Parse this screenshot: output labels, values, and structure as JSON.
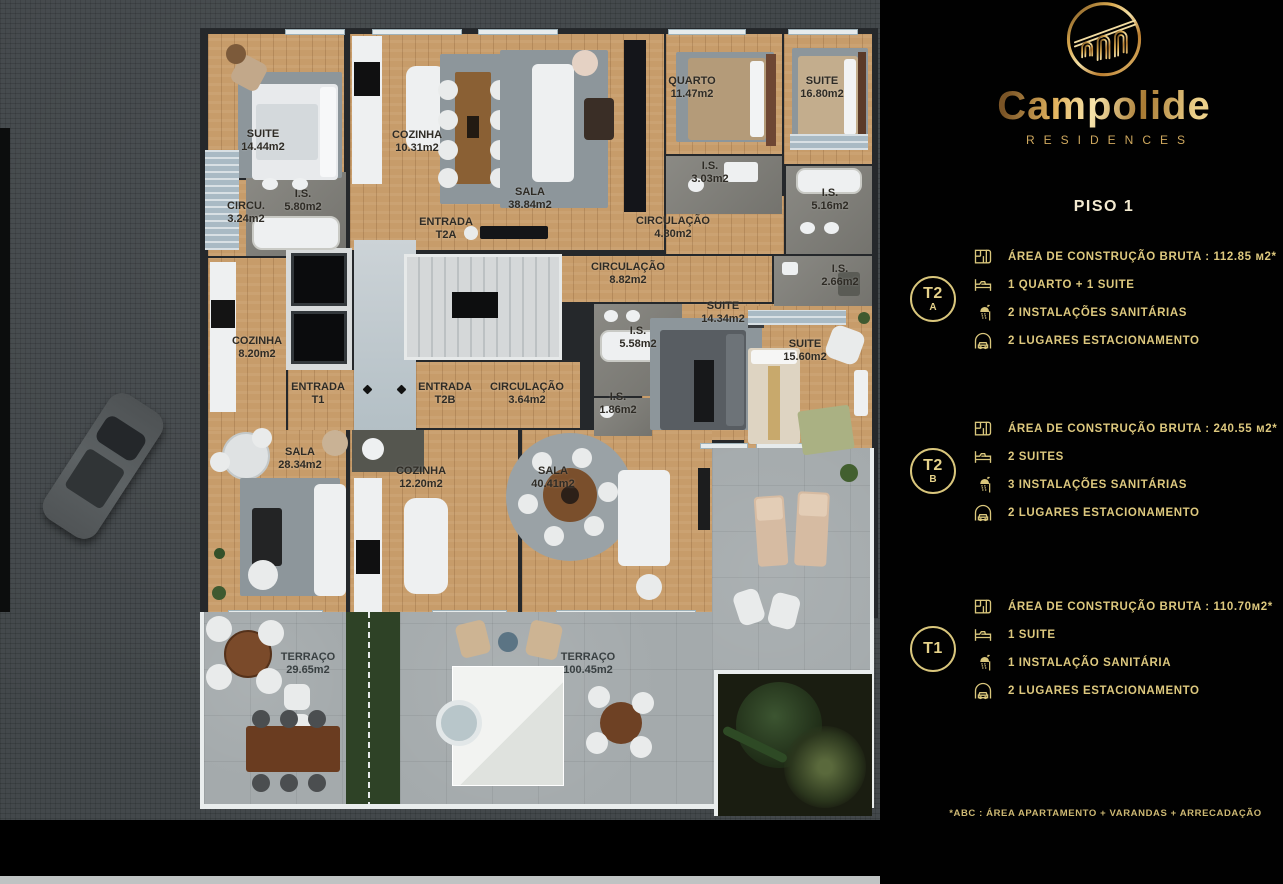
{
  "panel": {
    "brand": "Campolide",
    "brand_sub": "RESIDENCES",
    "floor_title": "PISO 1",
    "accent_color": "#d9c67c",
    "background_color": "#000000",
    "units": [
      {
        "badge": "T2",
        "badge_sub": "A",
        "rows": [
          {
            "icon": "floorplan-icon",
            "text": "ÁREA DE CONSTRUÇÃO BRUTA :  112.85 м2*"
          },
          {
            "icon": "bed-icon",
            "text": "1 QUARTO + 1 SUITE"
          },
          {
            "icon": "shower-icon",
            "text": "2 INSTALAÇÕES SANITÁRIAS"
          },
          {
            "icon": "garage-icon",
            "text": "2 LUGARES ESTACIONAMENTO"
          }
        ]
      },
      {
        "badge": "T2",
        "badge_sub": "B",
        "rows": [
          {
            "icon": "floorplan-icon",
            "text": "ÁREA DE CONSTRUÇÃO BRUTA :  240.55 м2*"
          },
          {
            "icon": "bed-icon",
            "text": "2 SUITES"
          },
          {
            "icon": "shower-icon",
            "text": "3 INSTALAÇÕES SANITÁRIAS"
          },
          {
            "icon": "garage-icon",
            "text": "2 LUGARES ESTACIONAMENTO"
          }
        ]
      },
      {
        "badge": "T1",
        "badge_sub": "",
        "rows": [
          {
            "icon": "floorplan-icon",
            "text": "ÁREA DE CONSTRUÇÃO BRUTA :  110.70м2*"
          },
          {
            "icon": "bed-icon",
            "text": "1 SUITE"
          },
          {
            "icon": "shower-icon",
            "text": "1 INSTALAÇÃO SANITÁRIA"
          },
          {
            "icon": "garage-icon",
            "text": "2 LUGARES ESTACIONAMENTO"
          }
        ]
      }
    ],
    "footnote": "*ABC :  ÁREA APARTAMENTO + VARANDAS + ARRECADAÇÃO"
  },
  "plan": {
    "floor_color": "#c79c6a",
    "terrace_color": "#a4aaac",
    "ground_color": "#43484b",
    "labels": {
      "suite_t1": {
        "name": "SUITE",
        "area": "14.44m2"
      },
      "circ_t1": {
        "name": "CIRCU.",
        "area": "3.24m2"
      },
      "is580": {
        "name": "I.S.",
        "area": "5.80m2"
      },
      "cozinha_t2a": {
        "name": "COZINHA",
        "area": "10.31m2"
      },
      "sala_t2a": {
        "name": "SALA",
        "area": "38.84m2"
      },
      "entrada_t2a": {
        "name": "ENTRADA",
        "area": "T2A"
      },
      "quarto_t2b": {
        "name": "QUARTO",
        "area": "11.47m2"
      },
      "is303": {
        "name": "I.S.",
        "area": "3.03m2"
      },
      "circ480": {
        "name": "CIRCULAÇÃO",
        "area": "4.80m2"
      },
      "suite1680": {
        "name": "SUITE",
        "area": "16.80m2"
      },
      "is516": {
        "name": "I.S.",
        "area": "5.16m2"
      },
      "circ882": {
        "name": "CIRCULAÇÃO",
        "area": "8.82m2"
      },
      "is266": {
        "name": "I.S.",
        "area": "2.66m2"
      },
      "suite1434": {
        "name": "SUITE",
        "area": "14.34m2"
      },
      "is558": {
        "name": "I.S.",
        "area": "5.58m2"
      },
      "suite1560": {
        "name": "SUITE",
        "area": "15.60m2"
      },
      "cozinha_t1": {
        "name": "COZINHA",
        "area": "8.20m2"
      },
      "entrada_t1": {
        "name": "ENTRADA",
        "area": "T1"
      },
      "entrada_t2b": {
        "name": "ENTRADA",
        "area": "T2B"
      },
      "circ364": {
        "name": "CIRCULAÇÃO",
        "area": "3.64m2"
      },
      "is186": {
        "name": "I.S.",
        "area": "1.86m2"
      },
      "sala_t1": {
        "name": "SALA",
        "area": "28.34m2"
      },
      "cozinha_t2b": {
        "name": "COZINHA",
        "area": "12.20m2"
      },
      "sala_t2b": {
        "name": "SALA",
        "area": "40.41m2"
      },
      "terraco_t1": {
        "name": "TERRAÇO",
        "area": "29.65m2"
      },
      "terraco_t2b": {
        "name": "TERRAÇO",
        "area": "100.45m2"
      }
    }
  }
}
